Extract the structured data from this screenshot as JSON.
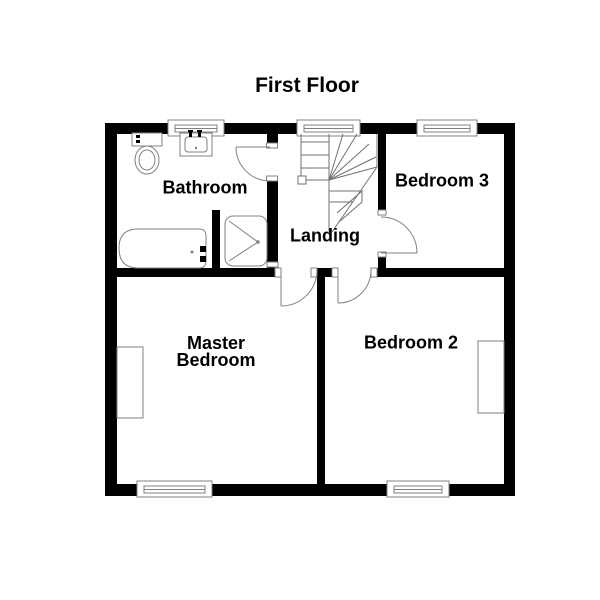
{
  "title": "First Floor",
  "rooms": {
    "bathroom": {
      "label": "Bathroom"
    },
    "landing": {
      "label": "Landing"
    },
    "bedroom3": {
      "label": "Bedroom 3"
    },
    "master": {
      "line1": "Master",
      "line2": "Bedroom"
    },
    "bedroom2": {
      "label": "Bedroom 2"
    }
  },
  "symbols": {
    "toilet": "toilet-icon",
    "sink": "sink-icon",
    "bathtub": "bathtub-icon",
    "shower": "shower-icon",
    "staircase": "staircase-icon",
    "windows_count": 5,
    "doors_count": 4,
    "furniture_count": 2
  },
  "colors": {
    "wall": "#000000",
    "line": "#808080",
    "stair_line": "#707070",
    "background": "#ffffff",
    "text": "#000000"
  }
}
